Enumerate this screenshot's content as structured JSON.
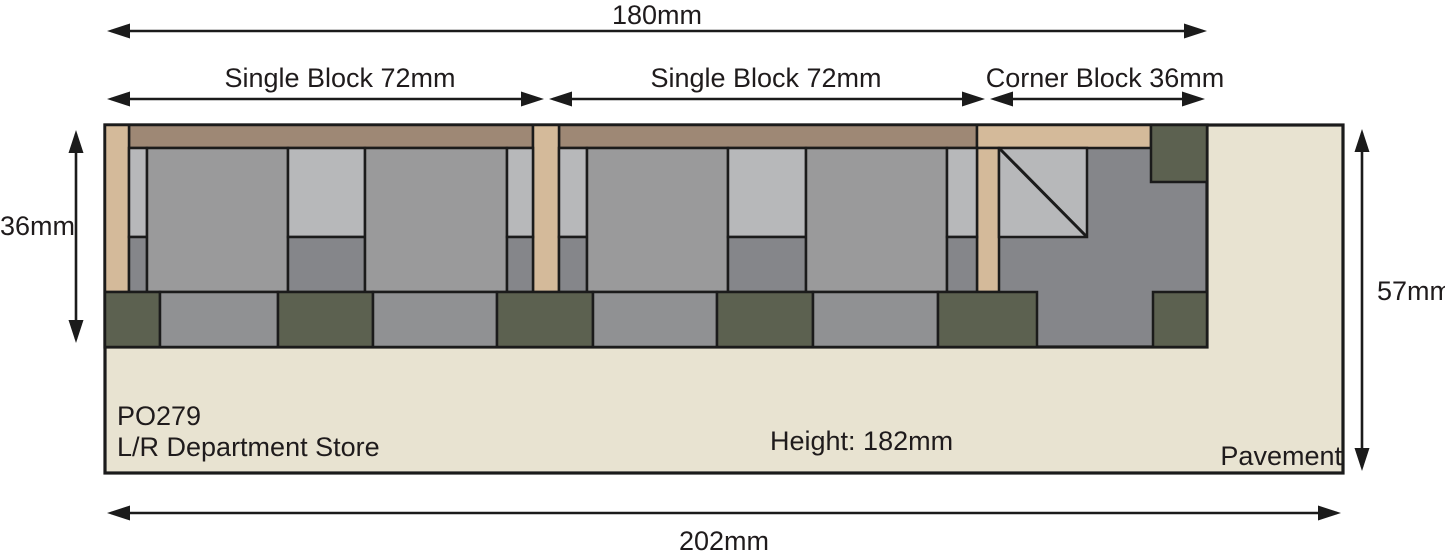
{
  "diagram": {
    "labels": {
      "total_width": "180mm",
      "single_block_1": "Single Block 72mm",
      "single_block_2": "Single Block 72mm",
      "corner_block": "Corner Block 36mm",
      "depth": "36mm",
      "pavement_depth": "57mm",
      "total_width_pavement": "202mm",
      "kit_code": "PO279",
      "kit_name": "L/R Department Store",
      "height_note": "Height: 182mm",
      "pavement_label": "Pavement"
    },
    "colors": {
      "cream": "#e8e3d1",
      "tan": "#d4ba9a",
      "brown": "#9e8875",
      "grayMain": "#9a9a9b",
      "grayLight": "#b7b8ba",
      "grayDark": "#85868a",
      "grayBand": "#909193",
      "green": "#5c6150",
      "line": "#1b1b1b",
      "text": "#1f1b1c"
    },
    "rects": [
      {
        "n": "pavement-slab",
        "x": 105,
        "y": 125,
        "w": 1238,
        "h": 348,
        "c": "cream",
        "sw": 3.2
      },
      {
        "n": "building-base",
        "x": 105,
        "y": 125,
        "w": 1102,
        "h": 222,
        "c": "grayDark",
        "sw": 3.2
      },
      {
        "n": "block1-top-band",
        "x": 129,
        "y": 125,
        "w": 404,
        "h": 23,
        "c": "brown"
      },
      {
        "n": "block2-top-band",
        "x": 559,
        "y": 125,
        "w": 418,
        "h": 23,
        "c": "brown"
      },
      {
        "n": "left-pilaster",
        "x": 105,
        "y": 125,
        "w": 24,
        "h": 167,
        "c": "tan"
      },
      {
        "n": "divider-pilaster",
        "x": 533,
        "y": 125,
        "w": 26,
        "h": 167,
        "c": "tan"
      },
      {
        "n": "corner-top-band",
        "x": 977,
        "y": 125,
        "w": 174,
        "h": 23,
        "c": "tan"
      },
      {
        "n": "corner-pilaster",
        "x": 977,
        "y": 148,
        "w": 22,
        "h": 144,
        "c": "tan"
      },
      {
        "n": "corner-green-square-top",
        "x": 1151,
        "y": 125,
        "w": 56,
        "h": 57,
        "c": "green"
      },
      {
        "n": "block1-strip-left-top",
        "x": 129,
        "y": 148,
        "w": 18,
        "h": 89,
        "c": "grayLight"
      },
      {
        "n": "block1-strip-left-bottom",
        "x": 129,
        "y": 237,
        "w": 18,
        "h": 55,
        "c": "grayDark"
      },
      {
        "n": "block1-panel-left",
        "x": 147,
        "y": 148,
        "w": 141,
        "h": 144,
        "c": "grayMain"
      },
      {
        "n": "block1-window-top",
        "x": 288,
        "y": 148,
        "w": 77,
        "h": 89,
        "c": "grayLight"
      },
      {
        "n": "block1-window-bottom",
        "x": 288,
        "y": 237,
        "w": 77,
        "h": 55,
        "c": "grayDark"
      },
      {
        "n": "block1-panel-right",
        "x": 365,
        "y": 148,
        "w": 142,
        "h": 144,
        "c": "grayMain"
      },
      {
        "n": "block1-strip-right-top",
        "x": 507,
        "y": 148,
        "w": 26,
        "h": 89,
        "c": "grayLight"
      },
      {
        "n": "block1-strip-right-bottom",
        "x": 507,
        "y": 237,
        "w": 26,
        "h": 55,
        "c": "grayDark"
      },
      {
        "n": "block2-strip-left-top",
        "x": 559,
        "y": 148,
        "w": 28,
        "h": 89,
        "c": "grayLight"
      },
      {
        "n": "block2-strip-left-bottom",
        "x": 559,
        "y": 237,
        "w": 28,
        "h": 55,
        "c": "grayDark"
      },
      {
        "n": "block2-panel-left",
        "x": 587,
        "y": 148,
        "w": 141,
        "h": 144,
        "c": "grayMain"
      },
      {
        "n": "block2-window-top",
        "x": 728,
        "y": 148,
        "w": 78,
        "h": 89,
        "c": "grayLight"
      },
      {
        "n": "block2-window-bottom",
        "x": 728,
        "y": 237,
        "w": 78,
        "h": 55,
        "c": "grayDark"
      },
      {
        "n": "block2-panel-right",
        "x": 806,
        "y": 148,
        "w": 141,
        "h": 144,
        "c": "grayMain"
      },
      {
        "n": "block2-strip-right-top",
        "x": 947,
        "y": 148,
        "w": 30,
        "h": 89,
        "c": "grayLight"
      },
      {
        "n": "block2-strip-right-bottom",
        "x": 947,
        "y": 237,
        "w": 30,
        "h": 55,
        "c": "grayDark"
      },
      {
        "n": "corner-stair-square",
        "x": 999,
        "y": 148,
        "w": 88,
        "h": 89,
        "c": "grayLight"
      },
      {
        "n": "base-band-green-1",
        "x": 105,
        "y": 292,
        "w": 55,
        "h": 55,
        "c": "green"
      },
      {
        "n": "base-band-gray-1",
        "x": 160,
        "y": 292,
        "w": 118,
        "h": 55,
        "c": "grayBand"
      },
      {
        "n": "base-band-green-2",
        "x": 278,
        "y": 292,
        "w": 95,
        "h": 55,
        "c": "green"
      },
      {
        "n": "base-band-gray-2",
        "x": 373,
        "y": 292,
        "w": 124,
        "h": 55,
        "c": "grayBand"
      },
      {
        "n": "base-band-green-3",
        "x": 497,
        "y": 292,
        "w": 96,
        "h": 55,
        "c": "green"
      },
      {
        "n": "base-band-gray-3",
        "x": 593,
        "y": 292,
        "w": 124,
        "h": 55,
        "c": "grayBand"
      },
      {
        "n": "base-band-green-4",
        "x": 717,
        "y": 292,
        "w": 96,
        "h": 55,
        "c": "green"
      },
      {
        "n": "base-band-gray-4",
        "x": 813,
        "y": 292,
        "w": 125,
        "h": 55,
        "c": "grayBand"
      },
      {
        "n": "base-band-green-5",
        "x": 938,
        "y": 292,
        "w": 99,
        "h": 55,
        "c": "green"
      },
      {
        "n": "base-band-green-6",
        "x": 1153,
        "y": 292,
        "w": 54,
        "h": 55,
        "c": "green"
      }
    ],
    "diagonal": {
      "x1": 999,
      "y1": 148,
      "x2": 1087,
      "y2": 237
    },
    "dimensions": [
      {
        "name": "total-width",
        "orient": "h",
        "x1": 107,
        "x2": 1207,
        "y": 31
      },
      {
        "name": "single-block-1",
        "orient": "h",
        "x1": 107,
        "x2": 544,
        "y": 99
      },
      {
        "name": "single-block-2",
        "orient": "h",
        "x1": 549,
        "x2": 985,
        "y": 99
      },
      {
        "name": "corner-block",
        "orient": "h",
        "x1": 990,
        "x2": 1205,
        "y": 99
      },
      {
        "name": "depth-36",
        "orient": "v",
        "x": 76,
        "y1": 130,
        "y2": 343
      },
      {
        "name": "pavement-depth-57",
        "orient": "v",
        "x": 1362,
        "y1": 129,
        "y2": 471
      },
      {
        "name": "total-width-pavement",
        "orient": "h",
        "x1": 107,
        "x2": 1341,
        "y": 513
      }
    ]
  }
}
